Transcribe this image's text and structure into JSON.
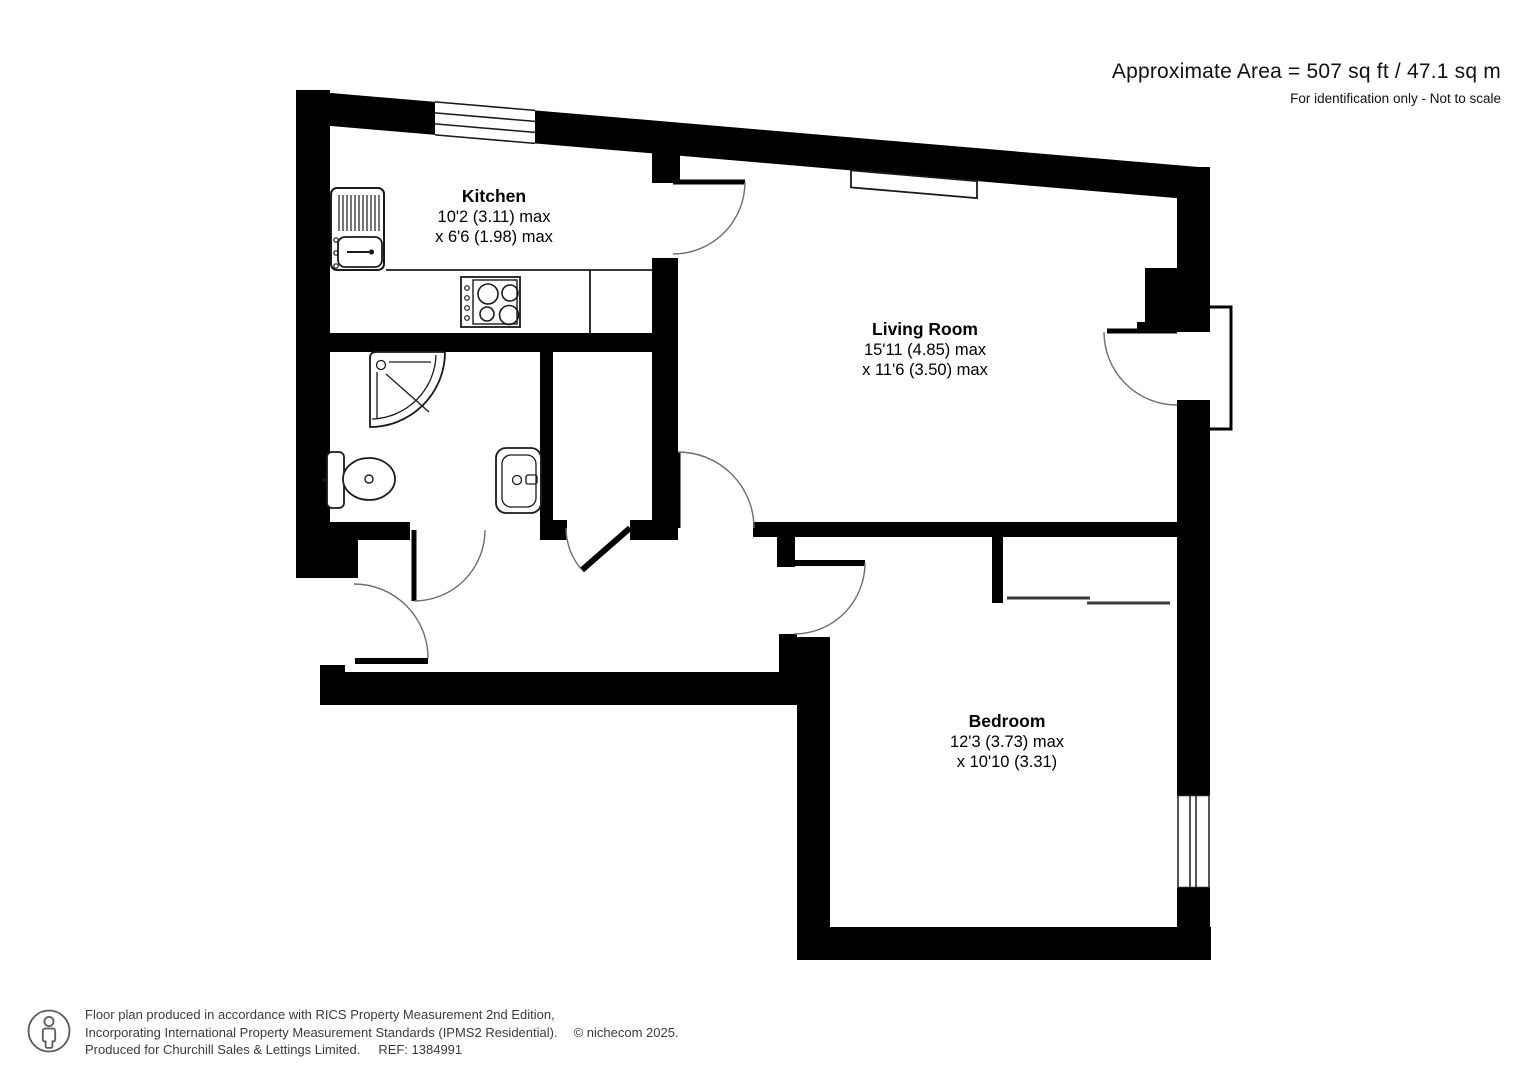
{
  "header": {
    "area": "Approximate Area = 507 sq ft / 47.1 sq m",
    "note": "For identification only - Not to scale"
  },
  "rooms": {
    "kitchen": {
      "name": "Kitchen",
      "dims": [
        "10'2 (3.11) max",
        "x 6'6 (1.98) max"
      ]
    },
    "living_room": {
      "name": "Living Room",
      "dims": [
        "15'11 (4.85) max",
        "x 11'6 (3.50) max"
      ]
    },
    "bedroom": {
      "name": "Bedroom",
      "dims": [
        "12'3 (3.73) max",
        "x 10'10 (3.31)"
      ]
    }
  },
  "footer": {
    "line1": "Floor plan produced in accordance with RICS Property Measurement 2nd Edition,",
    "line2": "Incorporating International Property Measurement Standards (IPMS2 Residential).",
    "copyright": "© nichecom 2025.",
    "line3": "Produced for Churchill Sales & Lettings Limited.",
    "ref": "REF: 1384991"
  },
  "colors": {
    "wall": "#000000",
    "background": "#ffffff",
    "arc": "#6e6e6e",
    "fixture": "#1a1a1a",
    "footer_text": "#3b3b3b"
  }
}
